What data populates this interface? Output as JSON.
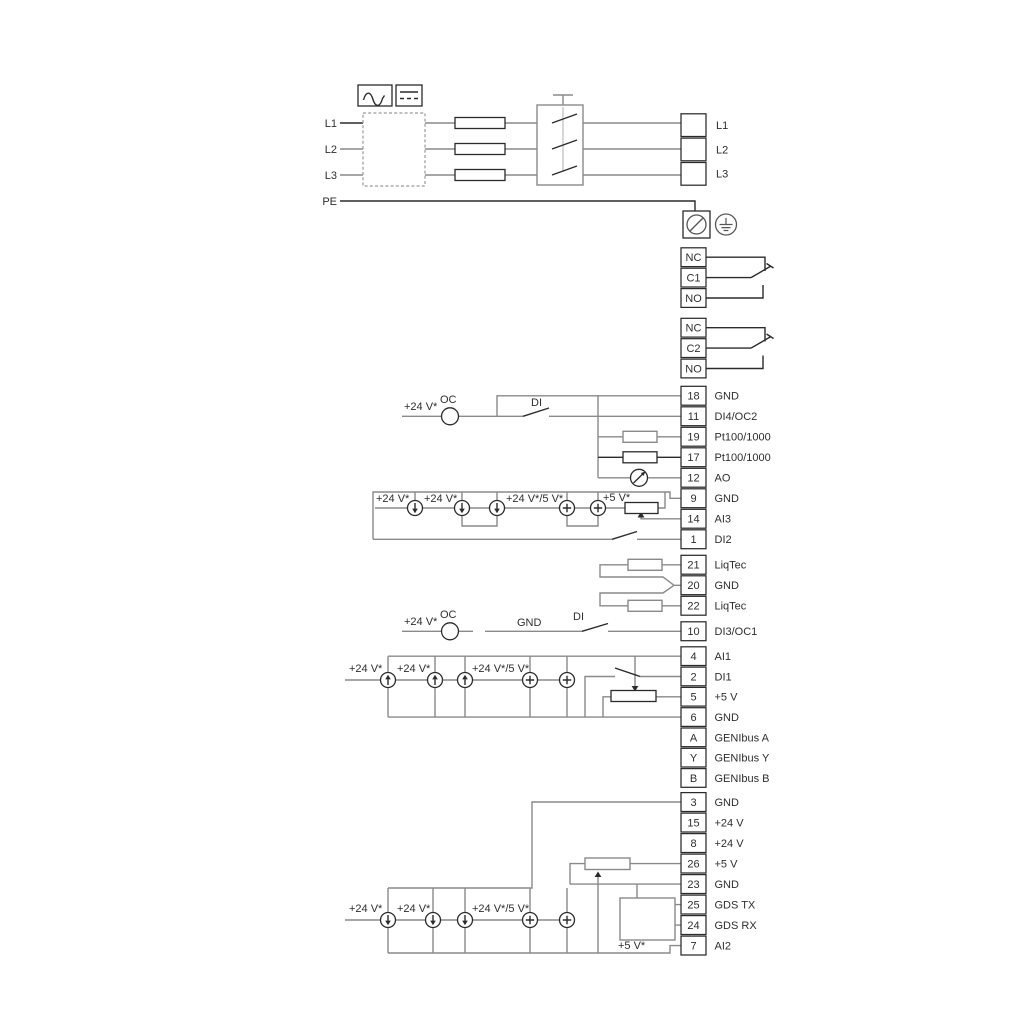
{
  "power": {
    "inputs": [
      "L1",
      "L2",
      "L3",
      "PE"
    ],
    "outputs": [
      "L1",
      "L2",
      "L3"
    ]
  },
  "relays": [
    {
      "terminals": [
        "NC",
        "C1",
        "NO"
      ]
    },
    {
      "terminals": [
        "NC",
        "C2",
        "NO"
      ]
    }
  ],
  "terminal_groups": [
    {
      "id": "io-top",
      "terminals": [
        [
          "18",
          "GND"
        ],
        [
          "11",
          "DI4/OC2"
        ],
        [
          "19",
          "Pt100/1000"
        ],
        [
          "17",
          "Pt100/1000"
        ],
        [
          "12",
          "AO"
        ],
        [
          "9",
          "GND"
        ],
        [
          "14",
          "AI3"
        ],
        [
          "1",
          "DI2"
        ]
      ]
    },
    {
      "id": "liqtec",
      "terminals": [
        [
          "21",
          "LiqTec"
        ],
        [
          "20",
          "GND"
        ],
        [
          "22",
          "LiqTec"
        ]
      ]
    },
    {
      "id": "di3",
      "terminals": [
        [
          "10",
          "DI3/OC1"
        ]
      ]
    },
    {
      "id": "io-mid",
      "terminals": [
        [
          "4",
          "AI1"
        ],
        [
          "2",
          "DI1"
        ],
        [
          "5",
          "+5 V"
        ],
        [
          "6",
          "GND"
        ],
        [
          "A",
          "GENIbus A"
        ],
        [
          "Y",
          "GENIbus Y"
        ],
        [
          "B",
          "GENIbus B"
        ]
      ]
    },
    {
      "id": "io-bottom",
      "terminals": [
        [
          "3",
          "GND"
        ],
        [
          "15",
          "+24 V"
        ],
        [
          "8",
          "+24 V"
        ],
        [
          "26",
          "+5 V"
        ],
        [
          "23",
          "GND"
        ],
        [
          "25",
          "GDS TX"
        ],
        [
          "24",
          "GDS RX"
        ],
        [
          "7",
          "AI2"
        ]
      ]
    }
  ],
  "labels": {
    "di4_row": {
      "v24": "+24 V*",
      "oc": "OC",
      "di": "DI"
    },
    "ai3_row": {
      "v24_a": "+24 V*",
      "v24_b": "+24 V*",
      "v24_5": "+24 V*/5 V*",
      "v5": "+5 V*"
    },
    "di3_row": {
      "v24": "+24 V*",
      "oc": "OC",
      "gnd": "GND",
      "di": "DI"
    },
    "ai1_row": {
      "v24_a": "+24 V*",
      "v24_b": "+24 V*",
      "v24_5": "+24 V*/5 V*"
    },
    "ai2_row": {
      "v24_a": "+24 V*",
      "v24_b": "+24 V*",
      "v24_5": "+24 V*/5 V*",
      "v5": "+5 V*"
    }
  },
  "colors": {
    "wire_gray": "#8a8a8a",
    "wire_dark": "#2b2b2b",
    "text": "#2e2e2e",
    "background": "#ffffff"
  }
}
